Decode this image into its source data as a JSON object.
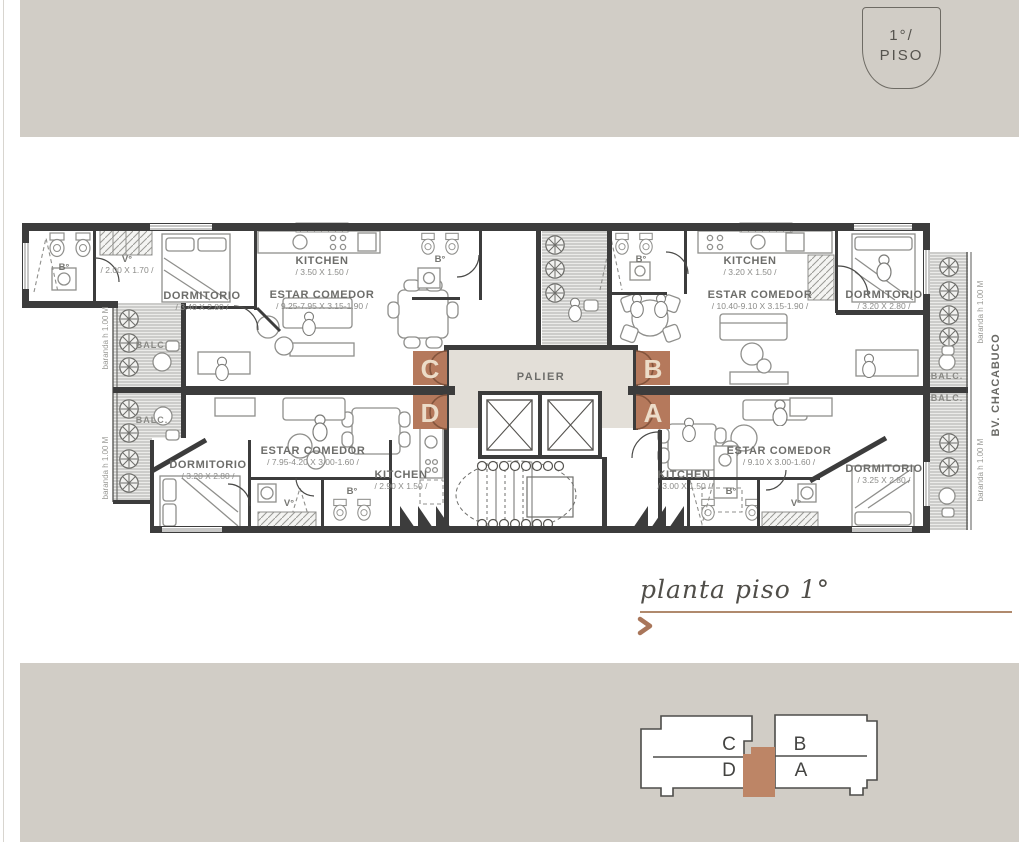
{
  "badge": {
    "floor": "1°/",
    "label": "PISO"
  },
  "caption": {
    "title": "planta piso 1°"
  },
  "plan": {
    "palier": "PALIER",
    "balc": "BALC.",
    "baranda": "baranda h 1.00 M",
    "street": "BV. CHACABUCO",
    "units": {
      "c": {
        "letter": "C",
        "bath": "B°",
        "bath2": "B°",
        "vestibule": "V°",
        "vestibule_dims": "/ 2.00 X 1.70 /",
        "kitchen": "KITCHEN",
        "kitchen_dims": "/ 3.50 X 1.50 /",
        "living": "ESTAR COMEDOR",
        "living_dims": "/ 9.25-7.95 X 3.15-1.90 /",
        "bedroom": "DORMITORIO",
        "bedroom_dims": "/ 3.40 X 2.80 /"
      },
      "d": {
        "letter": "D",
        "bath": "B°",
        "vestibule": "V°",
        "kitchen": "KITCHEN",
        "kitchen_dims": "/ 2.90 X 1.50 /",
        "living": "ESTAR COMEDOR",
        "living_dims": "/ 7.95-4.20 X 3.00-1.60 /",
        "bedroom": "DORMITORIO",
        "bedroom_dims": "/ 3.20 X 2.80 /"
      },
      "b": {
        "letter": "B",
        "bath": "B°",
        "kitchen": "KITCHEN",
        "kitchen_dims": "/ 3.20 X 1.50 /",
        "living": "ESTAR COMEDOR",
        "living_dims": "/ 10.40-9.10 X 3.15-1.90 /",
        "bedroom": "DORMITORIO",
        "bedroom_dims": "/ 3.20 X 2.80 /"
      },
      "a": {
        "letter": "A",
        "bath": "B°",
        "vestibule": "V°",
        "kitchen": "KITCHEN",
        "kitchen_dims": "/ 3.00 X 1.50 /",
        "living": "ESTAR COMEDOR",
        "living_dims": "/ 9.10 X 3.00-1.60 /",
        "bedroom": "DORMITORIO",
        "bedroom_dims": "/ 3.25 X 2.80 /"
      }
    }
  },
  "keyplan": {
    "c": "C",
    "d": "D",
    "b": "B",
    "a": "A"
  },
  "colors": {
    "band": "#d1cdc6",
    "wall": "#3c3c3c",
    "accent": "#b5795c",
    "palier_bg": "#e3dfd8",
    "underline": "#b08a6d",
    "keyplan_square": "#bd8566"
  }
}
